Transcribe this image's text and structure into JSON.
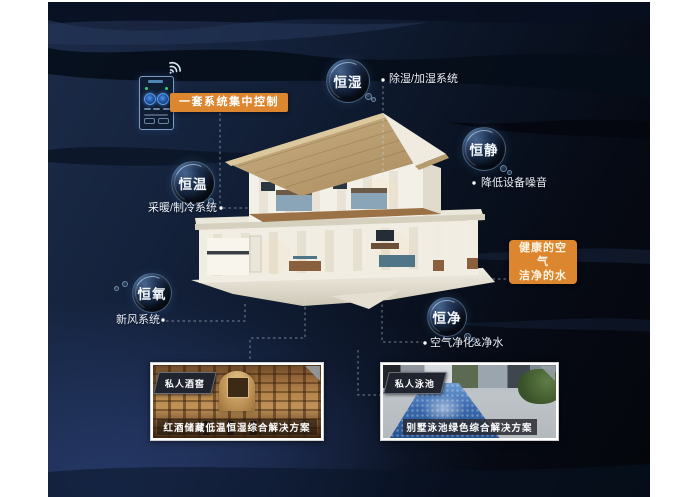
{
  "colors": {
    "accent_orange": "#DD8630",
    "panel_navy": "#14223C",
    "bubble_rim": "#91B9E1"
  },
  "control": {
    "pill_label": "一套系统集中控制"
  },
  "bubbles": [
    {
      "id": "heng-shi",
      "label": "恒湿"
    },
    {
      "id": "heng-jing",
      "label": "恒静"
    },
    {
      "id": "heng-wen",
      "label": "恒温"
    },
    {
      "id": "heng-yang",
      "label": "恒氧"
    },
    {
      "id": "heng-jing2",
      "label": "恒净"
    }
  ],
  "callouts": [
    {
      "id": "dehumidify",
      "label": "除湿/加湿系统"
    },
    {
      "id": "noise",
      "label": "降低设备噪音"
    },
    {
      "id": "hvac",
      "label": "采暖/制冷系统"
    },
    {
      "id": "fresh-air",
      "label": "新风系统"
    },
    {
      "id": "purify",
      "label": "空气净化&净水"
    }
  ],
  "highlight_box": {
    "line1": "健康的空气",
    "line2": "洁净的水"
  },
  "cards": [
    {
      "tag": "私人酒窖",
      "caption": "红酒储藏低温恒湿综合解决方案"
    },
    {
      "tag": "私人泳池",
      "caption": "别墅泳池绿色综合解决方案"
    }
  ],
  "icons": {
    "wifi": "wifi-signal-arcs",
    "phone": "smart-home-controller"
  }
}
